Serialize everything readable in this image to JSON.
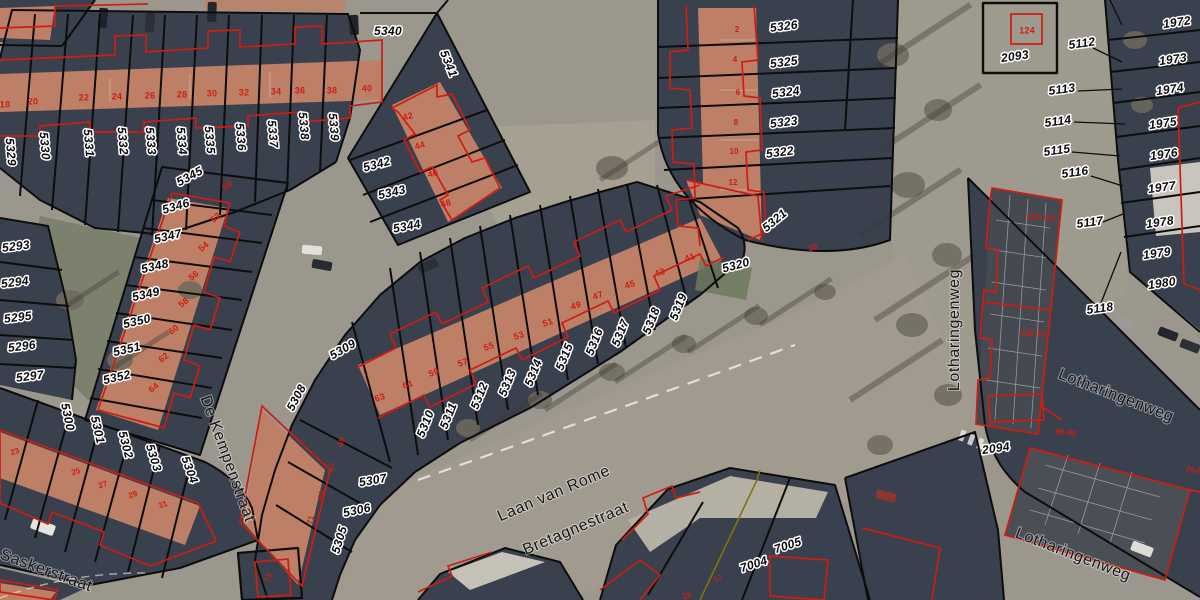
{
  "map": {
    "type": "cadastral-parcel-overlay-on-aerial-photo",
    "colors": {
      "parcel_line": "#0d0d0d",
      "building_outline": "#cf1d12",
      "alt_boundary": "#837408",
      "road": "#9c978c",
      "block": "#39404e",
      "roof": "#bd8066",
      "park": "#7b816d",
      "label_fill": "#0b0b0b",
      "label_halo": "#ffffff"
    },
    "street_names": [
      "Saskerstraat",
      "De Kempenstraat",
      "Laan van Rome",
      "Bretagnestraat",
      "Lotharingenweg"
    ],
    "labels": [
      {
        "t": "5329",
        "x": 10,
        "y": 152,
        "r": 85,
        "k": "p"
      },
      {
        "t": "5330",
        "x": 44,
        "y": 146,
        "r": 85,
        "k": "p"
      },
      {
        "t": "5331",
        "x": 88,
        "y": 143,
        "r": 85,
        "k": "p"
      },
      {
        "t": "5332",
        "x": 122,
        "y": 141,
        "r": 85,
        "k": "p"
      },
      {
        "t": "5333",
        "x": 150,
        "y": 141,
        "r": 85,
        "k": "p"
      },
      {
        "t": "5334",
        "x": 181,
        "y": 141,
        "r": 85,
        "k": "p"
      },
      {
        "t": "5335",
        "x": 209,
        "y": 140,
        "r": 85,
        "k": "p"
      },
      {
        "t": "5336",
        "x": 240,
        "y": 137,
        "r": 85,
        "k": "p"
      },
      {
        "t": "5337",
        "x": 272,
        "y": 134,
        "r": 85,
        "k": "p"
      },
      {
        "t": "5338",
        "x": 303,
        "y": 126,
        "r": 85,
        "k": "p"
      },
      {
        "t": "5339",
        "x": 333,
        "y": 127,
        "r": 85,
        "k": "p"
      },
      {
        "t": "5340",
        "x": 388,
        "y": 32,
        "r": 0,
        "k": "p"
      },
      {
        "t": "5341",
        "x": 448,
        "y": 64,
        "r": 68,
        "k": "p"
      },
      {
        "t": "5342",
        "x": 377,
        "y": 165,
        "r": -15,
        "k": "p"
      },
      {
        "t": "5343",
        "x": 392,
        "y": 193,
        "r": -13,
        "k": "p"
      },
      {
        "t": "5344",
        "x": 407,
        "y": 227,
        "r": -11,
        "k": "p"
      },
      {
        "t": "5345",
        "x": 190,
        "y": 177,
        "r": -28,
        "k": "p"
      },
      {
        "t": "5346",
        "x": 176,
        "y": 207,
        "r": -16,
        "k": "p"
      },
      {
        "t": "5347",
        "x": 168,
        "y": 237,
        "r": -13,
        "k": "p"
      },
      {
        "t": "5348",
        "x": 155,
        "y": 267,
        "r": -13,
        "k": "p"
      },
      {
        "t": "5349",
        "x": 146,
        "y": 295,
        "r": -13,
        "k": "p"
      },
      {
        "t": "5350",
        "x": 137,
        "y": 322,
        "r": -13,
        "k": "p"
      },
      {
        "t": "5351",
        "x": 127,
        "y": 350,
        "r": -13,
        "k": "p"
      },
      {
        "t": "5352",
        "x": 117,
        "y": 378,
        "r": -13,
        "k": "p"
      },
      {
        "t": "5293",
        "x": 16,
        "y": 247,
        "r": -7,
        "k": "p"
      },
      {
        "t": "5294",
        "x": 15,
        "y": 283,
        "r": -7,
        "k": "p"
      },
      {
        "t": "5295",
        "x": 18,
        "y": 318,
        "r": -7,
        "k": "p"
      },
      {
        "t": "5296",
        "x": 22,
        "y": 347,
        "r": -7,
        "k": "p"
      },
      {
        "t": "5297",
        "x": 30,
        "y": 377,
        "r": -7,
        "k": "p"
      },
      {
        "t": "5300",
        "x": 67,
        "y": 417,
        "r": 78,
        "k": "p"
      },
      {
        "t": "5301",
        "x": 97,
        "y": 430,
        "r": 77,
        "k": "p"
      },
      {
        "t": "5302",
        "x": 125,
        "y": 445,
        "r": 75,
        "k": "p"
      },
      {
        "t": "5303",
        "x": 153,
        "y": 458,
        "r": 73,
        "k": "p"
      },
      {
        "t": "5304",
        "x": 189,
        "y": 470,
        "r": 70,
        "k": "p"
      },
      {
        "t": "5305",
        "x": 340,
        "y": 540,
        "r": -73,
        "k": "p"
      },
      {
        "t": "5306",
        "x": 357,
        "y": 511,
        "r": -12,
        "k": "p"
      },
      {
        "t": "5307",
        "x": 373,
        "y": 481,
        "r": -10,
        "k": "p"
      },
      {
        "t": "5308",
        "x": 297,
        "y": 398,
        "r": -62,
        "k": "p"
      },
      {
        "t": "5309",
        "x": 343,
        "y": 350,
        "r": -30,
        "k": "p"
      },
      {
        "t": "5310",
        "x": 426,
        "y": 424,
        "r": -68,
        "k": "p"
      },
      {
        "t": "5311",
        "x": 449,
        "y": 416,
        "r": -68,
        "k": "p"
      },
      {
        "t": "5312",
        "x": 480,
        "y": 396,
        "r": -68,
        "k": "p"
      },
      {
        "t": "5313",
        "x": 508,
        "y": 383,
        "r": -68,
        "k": "p"
      },
      {
        "t": "5314",
        "x": 534,
        "y": 373,
        "r": -68,
        "k": "p"
      },
      {
        "t": "5315",
        "x": 565,
        "y": 357,
        "r": -68,
        "k": "p"
      },
      {
        "t": "5316",
        "x": 595,
        "y": 342,
        "r": -68,
        "k": "p"
      },
      {
        "t": "5317",
        "x": 621,
        "y": 333,
        "r": -68,
        "k": "p"
      },
      {
        "t": "5318",
        "x": 652,
        "y": 321,
        "r": -68,
        "k": "p"
      },
      {
        "t": "5319",
        "x": 679,
        "y": 307,
        "r": -68,
        "k": "p"
      },
      {
        "t": "5320",
        "x": 736,
        "y": 266,
        "r": -15,
        "k": "p"
      },
      {
        "t": "5321",
        "x": 775,
        "y": 221,
        "r": -40,
        "k": "p"
      },
      {
        "t": "5322",
        "x": 780,
        "y": 153,
        "r": -7,
        "k": "p"
      },
      {
        "t": "5323",
        "x": 784,
        "y": 123,
        "r": -7,
        "k": "p"
      },
      {
        "t": "5324",
        "x": 786,
        "y": 93,
        "r": -7,
        "k": "p"
      },
      {
        "t": "5325",
        "x": 784,
        "y": 63,
        "r": -7,
        "k": "p"
      },
      {
        "t": "5326",
        "x": 784,
        "y": 27,
        "r": -7,
        "k": "p"
      },
      {
        "t": "2093",
        "x": 1015,
        "y": 57,
        "r": -8,
        "k": "p"
      },
      {
        "t": "2094",
        "x": 996,
        "y": 449,
        "r": -8,
        "k": "p"
      },
      {
        "t": "5112",
        "x": 1082,
        "y": 44,
        "r": -8,
        "k": "p"
      },
      {
        "t": "5113",
        "x": 1062,
        "y": 90,
        "r": -8,
        "k": "p"
      },
      {
        "t": "5114",
        "x": 1058,
        "y": 122,
        "r": -8,
        "k": "p"
      },
      {
        "t": "5115",
        "x": 1057,
        "y": 151,
        "r": -8,
        "k": "p"
      },
      {
        "t": "5116",
        "x": 1075,
        "y": 173,
        "r": -8,
        "k": "p"
      },
      {
        "t": "5117",
        "x": 1090,
        "y": 223,
        "r": -8,
        "k": "p"
      },
      {
        "t": "5118",
        "x": 1100,
        "y": 309,
        "r": -8,
        "k": "p"
      },
      {
        "t": "1972",
        "x": 1177,
        "y": 23,
        "r": -8,
        "k": "p"
      },
      {
        "t": "1973",
        "x": 1173,
        "y": 60,
        "r": -8,
        "k": "p"
      },
      {
        "t": "1974",
        "x": 1170,
        "y": 90,
        "r": -8,
        "k": "p"
      },
      {
        "t": "1975",
        "x": 1163,
        "y": 124,
        "r": -8,
        "k": "p"
      },
      {
        "t": "1976",
        "x": 1164,
        "y": 155,
        "r": -8,
        "k": "p"
      },
      {
        "t": "1977",
        "x": 1162,
        "y": 188,
        "r": -8,
        "k": "p"
      },
      {
        "t": "1978",
        "x": 1160,
        "y": 223,
        "r": -8,
        "k": "p"
      },
      {
        "t": "1979",
        "x": 1157,
        "y": 254,
        "r": -8,
        "k": "p"
      },
      {
        "t": "1980",
        "x": 1162,
        "y": 284,
        "r": -8,
        "k": "p"
      },
      {
        "t": "7004",
        "x": 754,
        "y": 565,
        "r": -18,
        "k": "p"
      },
      {
        "t": "7005",
        "x": 788,
        "y": 546,
        "r": -18,
        "k": "p"
      },
      {
        "t": "Saskerstraat",
        "x": 46,
        "y": 571,
        "r": 20,
        "k": "s",
        "s": 16
      },
      {
        "t": "De Kempenstraat",
        "x": 227,
        "y": 459,
        "r": 70,
        "k": "s",
        "s": 15
      },
      {
        "t": "Laan van Rome",
        "x": 554,
        "y": 494,
        "r": -23,
        "k": "s",
        "s": 17
      },
      {
        "t": "Bretagnestraat",
        "x": 576,
        "y": 529,
        "r": -23,
        "k": "s",
        "s": 15
      },
      {
        "t": "Lotharingenweg",
        "x": 955,
        "y": 330,
        "r": -90,
        "k": "s",
        "s": 15
      },
      {
        "t": "Lotharingenweg",
        "x": 1116,
        "y": 396,
        "r": 21,
        "k": "s",
        "s": 15
      },
      {
        "t": "Lotharingenweg",
        "x": 1073,
        "y": 555,
        "r": 21,
        "k": "s",
        "s": 15
      },
      {
        "t": "18",
        "x": 5,
        "y": 105,
        "r": 0,
        "k": "h"
      },
      {
        "t": "20",
        "x": 33,
        "y": 102,
        "r": 0,
        "k": "h"
      },
      {
        "t": "22",
        "x": 84,
        "y": 98,
        "r": 0,
        "k": "h"
      },
      {
        "t": "24",
        "x": 117,
        "y": 97,
        "r": 0,
        "k": "h"
      },
      {
        "t": "26",
        "x": 150,
        "y": 96,
        "r": 0,
        "k": "h"
      },
      {
        "t": "28",
        "x": 182,
        "y": 95,
        "r": 0,
        "k": "h"
      },
      {
        "t": "30",
        "x": 212,
        "y": 94,
        "r": 0,
        "k": "h"
      },
      {
        "t": "32",
        "x": 244,
        "y": 93,
        "r": 0,
        "k": "h"
      },
      {
        "t": "34",
        "x": 276,
        "y": 92,
        "r": 0,
        "k": "h"
      },
      {
        "t": "36",
        "x": 300,
        "y": 91,
        "r": 0,
        "k": "h"
      },
      {
        "t": "38",
        "x": 332,
        "y": 91,
        "r": 0,
        "k": "h"
      },
      {
        "t": "40",
        "x": 367,
        "y": 89,
        "r": 0,
        "k": "h"
      },
      {
        "t": "42",
        "x": 408,
        "y": 117,
        "r": -15,
        "k": "h"
      },
      {
        "t": "44",
        "x": 420,
        "y": 146,
        "r": -15,
        "k": "h"
      },
      {
        "t": "46",
        "x": 433,
        "y": 174,
        "r": -15,
        "k": "h"
      },
      {
        "t": "48",
        "x": 446,
        "y": 204,
        "r": -15,
        "k": "h"
      },
      {
        "t": "50",
        "x": 228,
        "y": 186,
        "r": -40,
        "k": "h"
      },
      {
        "t": "52",
        "x": 216,
        "y": 218,
        "r": -40,
        "k": "h"
      },
      {
        "t": "54",
        "x": 204,
        "y": 247,
        "r": -40,
        "k": "h"
      },
      {
        "t": "56",
        "x": 194,
        "y": 276,
        "r": -40,
        "k": "h"
      },
      {
        "t": "58",
        "x": 184,
        "y": 303,
        "r": -40,
        "k": "h"
      },
      {
        "t": "60",
        "x": 174,
        "y": 330,
        "r": -40,
        "k": "h"
      },
      {
        "t": "62",
        "x": 164,
        "y": 358,
        "r": -40,
        "k": "h"
      },
      {
        "t": "64",
        "x": 154,
        "y": 388,
        "r": -40,
        "k": "h"
      },
      {
        "t": "39",
        "x": 813,
        "y": 248,
        "r": -20,
        "k": "e"
      },
      {
        "t": "41",
        "x": 690,
        "y": 258,
        "r": -20,
        "k": "h"
      },
      {
        "t": "43",
        "x": 660,
        "y": 273,
        "r": -20,
        "k": "h"
      },
      {
        "t": "45",
        "x": 630,
        "y": 285,
        "r": -20,
        "k": "h"
      },
      {
        "t": "47",
        "x": 598,
        "y": 296,
        "r": -20,
        "k": "h"
      },
      {
        "t": "49",
        "x": 576,
        "y": 306,
        "r": -20,
        "k": "h"
      },
      {
        "t": "51",
        "x": 548,
        "y": 323,
        "r": -20,
        "k": "h"
      },
      {
        "t": "53",
        "x": 519,
        "y": 336,
        "r": -20,
        "k": "h"
      },
      {
        "t": "55",
        "x": 489,
        "y": 347,
        "r": -20,
        "k": "h"
      },
      {
        "t": "57",
        "x": 463,
        "y": 363,
        "r": -20,
        "k": "h"
      },
      {
        "t": "59",
        "x": 434,
        "y": 373,
        "r": -20,
        "k": "h"
      },
      {
        "t": "61",
        "x": 408,
        "y": 385,
        "r": -20,
        "k": "h"
      },
      {
        "t": "63",
        "x": 380,
        "y": 398,
        "r": -20,
        "k": "h"
      },
      {
        "t": "65",
        "x": 342,
        "y": 442,
        "r": -75,
        "k": "e"
      },
      {
        "t": "67",
        "x": 332,
        "y": 467,
        "r": -75,
        "k": "e"
      },
      {
        "t": "69",
        "x": 322,
        "y": 495,
        "r": -75,
        "k": "e"
      },
      {
        "t": "71",
        "x": 311,
        "y": 520,
        "r": -75,
        "k": "e"
      },
      {
        "t": "73",
        "x": 269,
        "y": 578,
        "r": -75,
        "k": "e"
      },
      {
        "t": "124",
        "x": 1027,
        "y": 31,
        "r": 0,
        "k": "h"
      },
      {
        "t": "17",
        "x": 718,
        "y": 579,
        "r": -18,
        "k": "e"
      },
      {
        "t": "15",
        "x": 687,
        "y": 596,
        "r": -18,
        "k": "e"
      },
      {
        "t": "23",
        "x": 15,
        "y": 452,
        "r": -18,
        "k": "e",
        "s": 7
      },
      {
        "t": "25",
        "x": 76,
        "y": 472,
        "r": -18,
        "k": "e",
        "s": 7
      },
      {
        "t": "27",
        "x": 103,
        "y": 485,
        "r": -18,
        "k": "e",
        "s": 7
      },
      {
        "t": "29",
        "x": 133,
        "y": 495,
        "r": -18,
        "k": "e",
        "s": 7
      },
      {
        "t": "31",
        "x": 163,
        "y": 505,
        "r": -18,
        "k": "e",
        "s": 7
      },
      {
        "t": "2",
        "x": 737,
        "y": 30,
        "r": 0,
        "k": "e",
        "s": 7
      },
      {
        "t": "4",
        "x": 735,
        "y": 60,
        "r": 0,
        "k": "e",
        "s": 7
      },
      {
        "t": "6",
        "x": 738,
        "y": 93,
        "r": 0,
        "k": "e",
        "s": 7
      },
      {
        "t": "8",
        "x": 736,
        "y": 123,
        "r": 0,
        "k": "e",
        "s": 7
      },
      {
        "t": "10",
        "x": 734,
        "y": 152,
        "r": 0,
        "k": "e",
        "s": 7
      },
      {
        "t": "12",
        "x": 733,
        "y": 183,
        "r": 0,
        "k": "e",
        "s": 7
      },
      {
        "t": "112-122",
        "x": 1041,
        "y": 218,
        "r": 4,
        "k": "e"
      },
      {
        "t": "100-110",
        "x": 1035,
        "y": 334,
        "r": 4,
        "k": "e"
      },
      {
        "t": "86-98",
        "x": 1066,
        "y": 433,
        "r": 8,
        "k": "e"
      },
      {
        "t": "76-86",
        "x": 1196,
        "y": 471,
        "r": 8,
        "k": "e"
      }
    ]
  }
}
